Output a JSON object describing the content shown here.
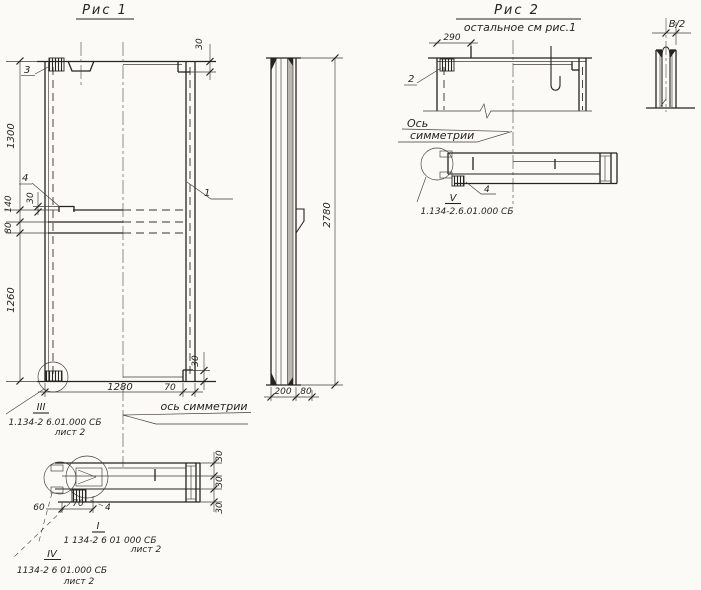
{
  "sheet": {
    "paper_color": "#fbfaf6",
    "ink_color": "#26241f"
  },
  "fig1": {
    "title": "Рис 1",
    "labels": {
      "item1": "1",
      "item3": "3",
      "item4": "4"
    },
    "dims": {
      "h1300": "1300",
      "h140": "140",
      "tab30": "30",
      "h80": "80",
      "h1260": "1260",
      "w1280": "1280",
      "w70": "70",
      "top30": "30",
      "bottom30": "30"
    },
    "axis_label": "ось симметрии",
    "detail3": {
      "mark": "III",
      "ref": "1.134-2 6.01.000 СБ",
      "sheet": "лист 2"
    },
    "section": {
      "dim60": "60",
      "dim70": "70",
      "dim30a": "30",
      "dim30b": "30",
      "dim30c": "30",
      "label4": "4",
      "markI": "I",
      "refI": "1 134-2 6 01 000 СБ",
      "sheetI": "лист 2",
      "markIV": "IV",
      "refIV": "1134-2 6 01.000 СБ",
      "sheetIV": "лист 2"
    }
  },
  "side_view": {
    "dims": {
      "h2780": "2780",
      "w200": "200",
      "w80": "80"
    }
  },
  "fig2": {
    "title": "Рис 2",
    "subtitle": "остальное см рис.1",
    "labels": {
      "item2": "2",
      "item4": "4"
    },
    "dims": {
      "w290": "290"
    },
    "axis_label_line1": "Ось",
    "axis_label_line2": "симметрии",
    "detail5": {
      "mark": "V",
      "ref": "1.134-2.6.01.000 СБ"
    }
  },
  "loop_detail": {
    "dim": "В/2"
  }
}
